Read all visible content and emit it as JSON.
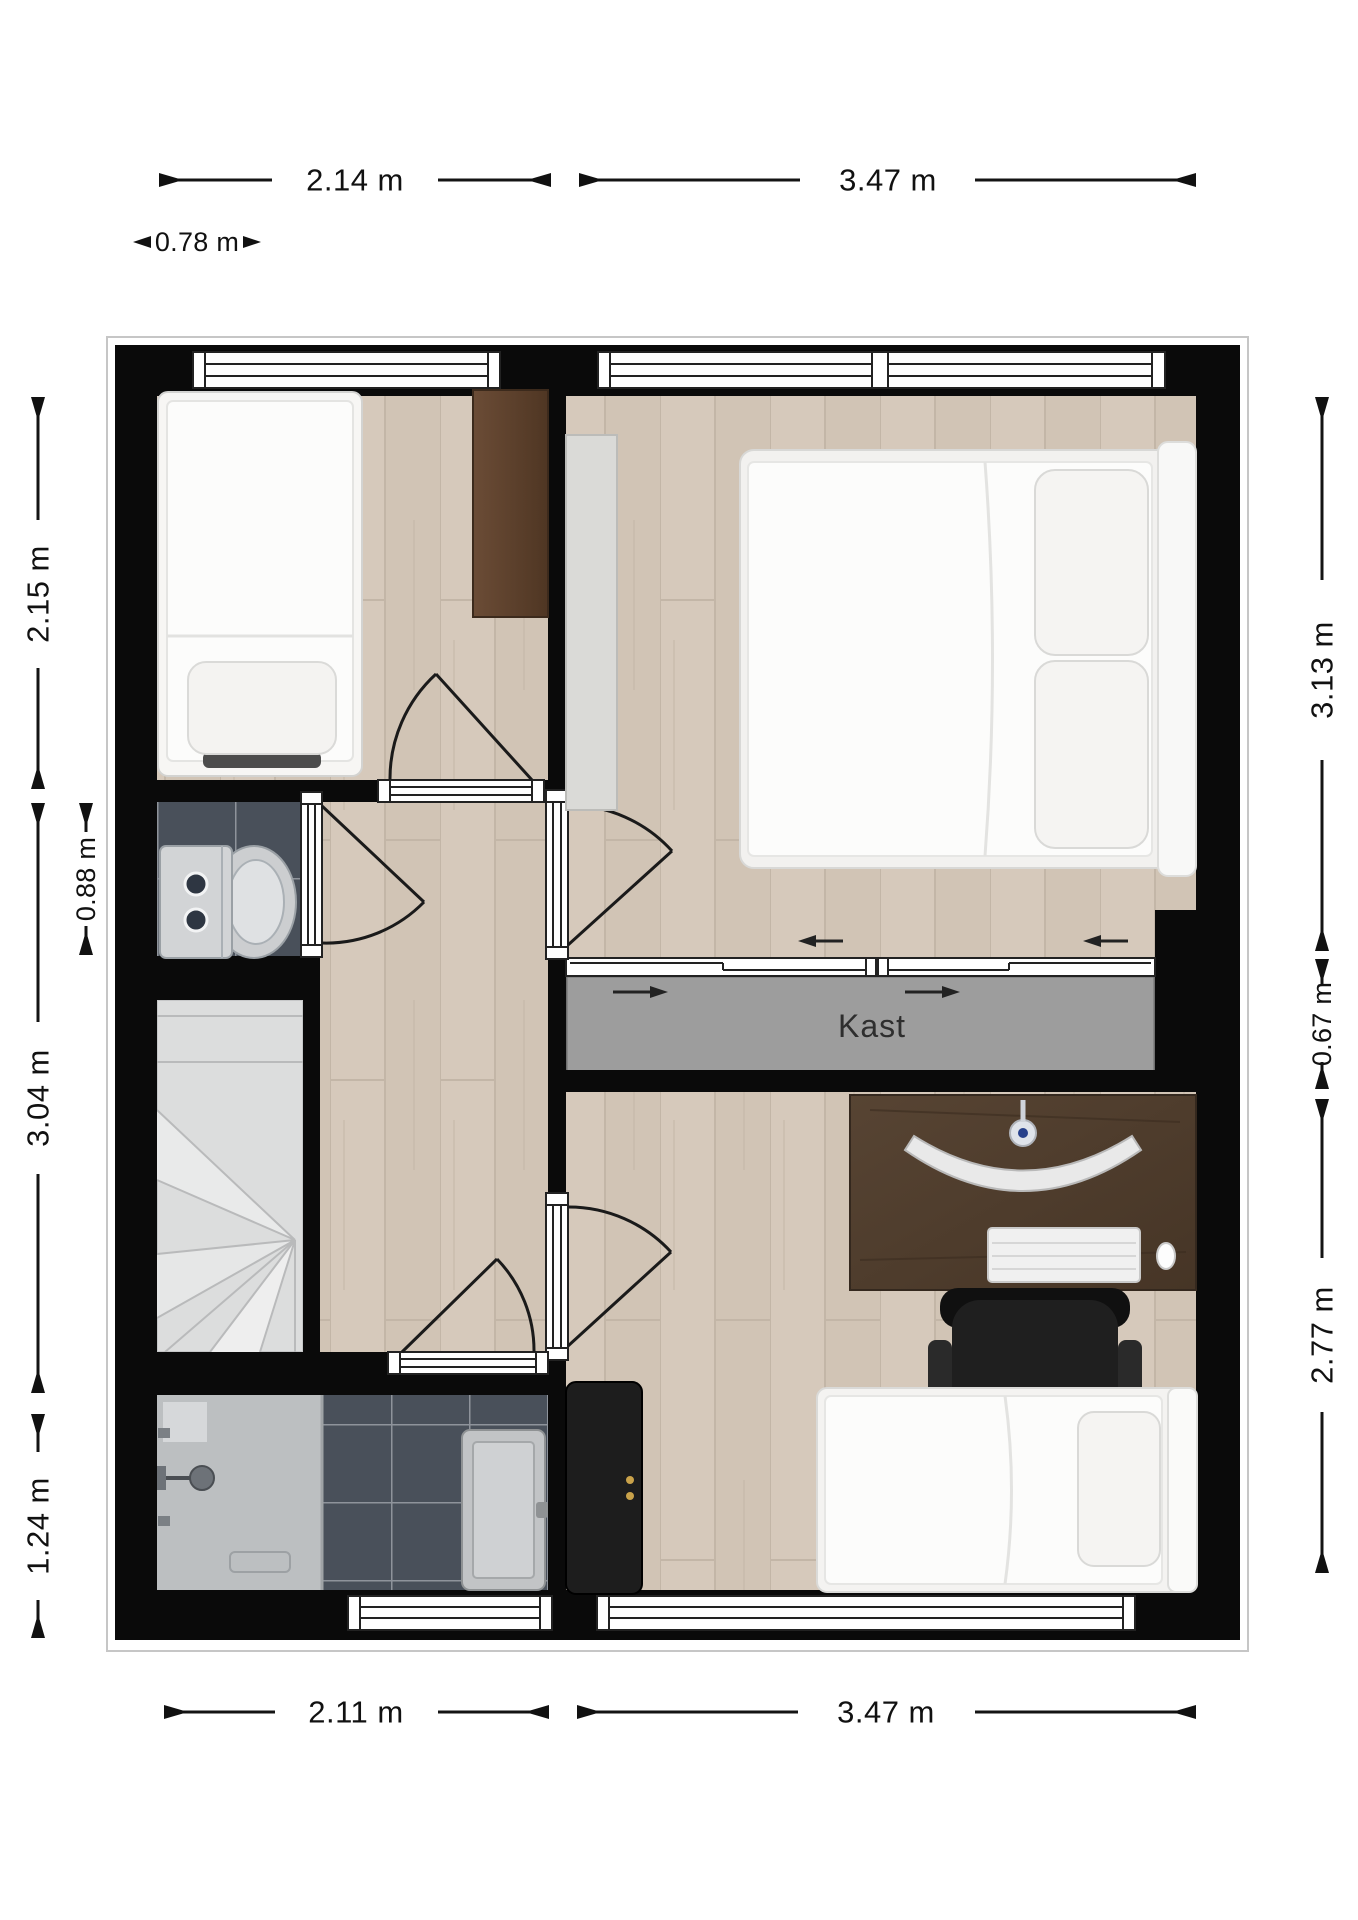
{
  "labels": {
    "closet": "Kast"
  },
  "dims": {
    "top_left": "2.14 m",
    "top_right": "3.47 m",
    "entry": "0.78 m",
    "left_bedroom1": "2.15 m",
    "left_toilet": "0.88 m",
    "left_hall": "3.04 m",
    "left_bathroom": "1.24 m",
    "right_bedroom2": "3.13 m",
    "right_closet": "0.67 m",
    "right_bedroom3": "2.77 m",
    "bottom_left": "2.11 m",
    "bottom_right": "3.47 m"
  },
  "colors": {
    "wall": "#0a0a0a",
    "wood_floor": "#d5c8ba",
    "dark_tile": "#49505a",
    "tile_grout": "#8e939b",
    "closet_fill": "#9d9d9d",
    "closet_border": "#6f6f6f",
    "stairs_fill": "#dcdddd",
    "desk_brown": "#4a392b",
    "wardrobe_brown": "#5e4331",
    "dresser_black": "#1d1d1d",
    "shower_gray": "#bcbfc1",
    "furniture_white": "#f7f6f4",
    "dimension_text": "#111111",
    "background": "#ffffff"
  }
}
